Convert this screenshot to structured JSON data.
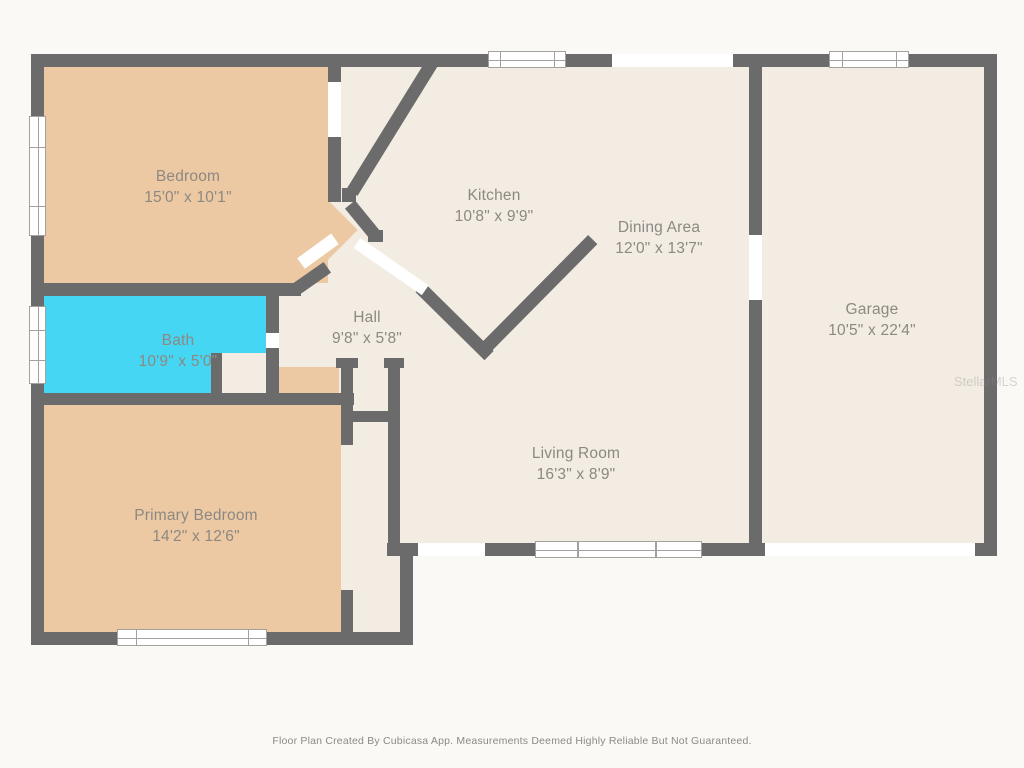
{
  "plan": {
    "rooms": [
      {
        "id": "bedroom",
        "name": "Bedroom",
        "dims": "15'0\" x 10'1\""
      },
      {
        "id": "kitchen",
        "name": "Kitchen",
        "dims": "10'8\" x 9'9\""
      },
      {
        "id": "dining",
        "name": "Dining Area",
        "dims": "12'0\" x 13'7\""
      },
      {
        "id": "garage",
        "name": "Garage",
        "dims": "10'5\" x 22'4\""
      },
      {
        "id": "bath",
        "name": "Bath",
        "dims": "10'9\" x 5'0\""
      },
      {
        "id": "hall",
        "name": "Hall",
        "dims": "9'8\" x 5'8\""
      },
      {
        "id": "primary",
        "name": "Primary Bedroom",
        "dims": "14'2\" x 12'6\""
      },
      {
        "id": "living",
        "name": "Living Room",
        "dims": "16'3\" x 8'9\""
      }
    ],
    "footer": "Floor Plan Created By Cubicasa App. Measurements Deemed Highly Reliable But Not Guaranteed.",
    "watermark": "StellarMLS",
    "colors": {
      "wall": "#6c6b6c",
      "floor": "#f2ece3",
      "room_tan": "#ecc9a3",
      "bath_cyan": "#45d6f3",
      "label": "#8d8882",
      "background": "#fbf9f6"
    }
  }
}
